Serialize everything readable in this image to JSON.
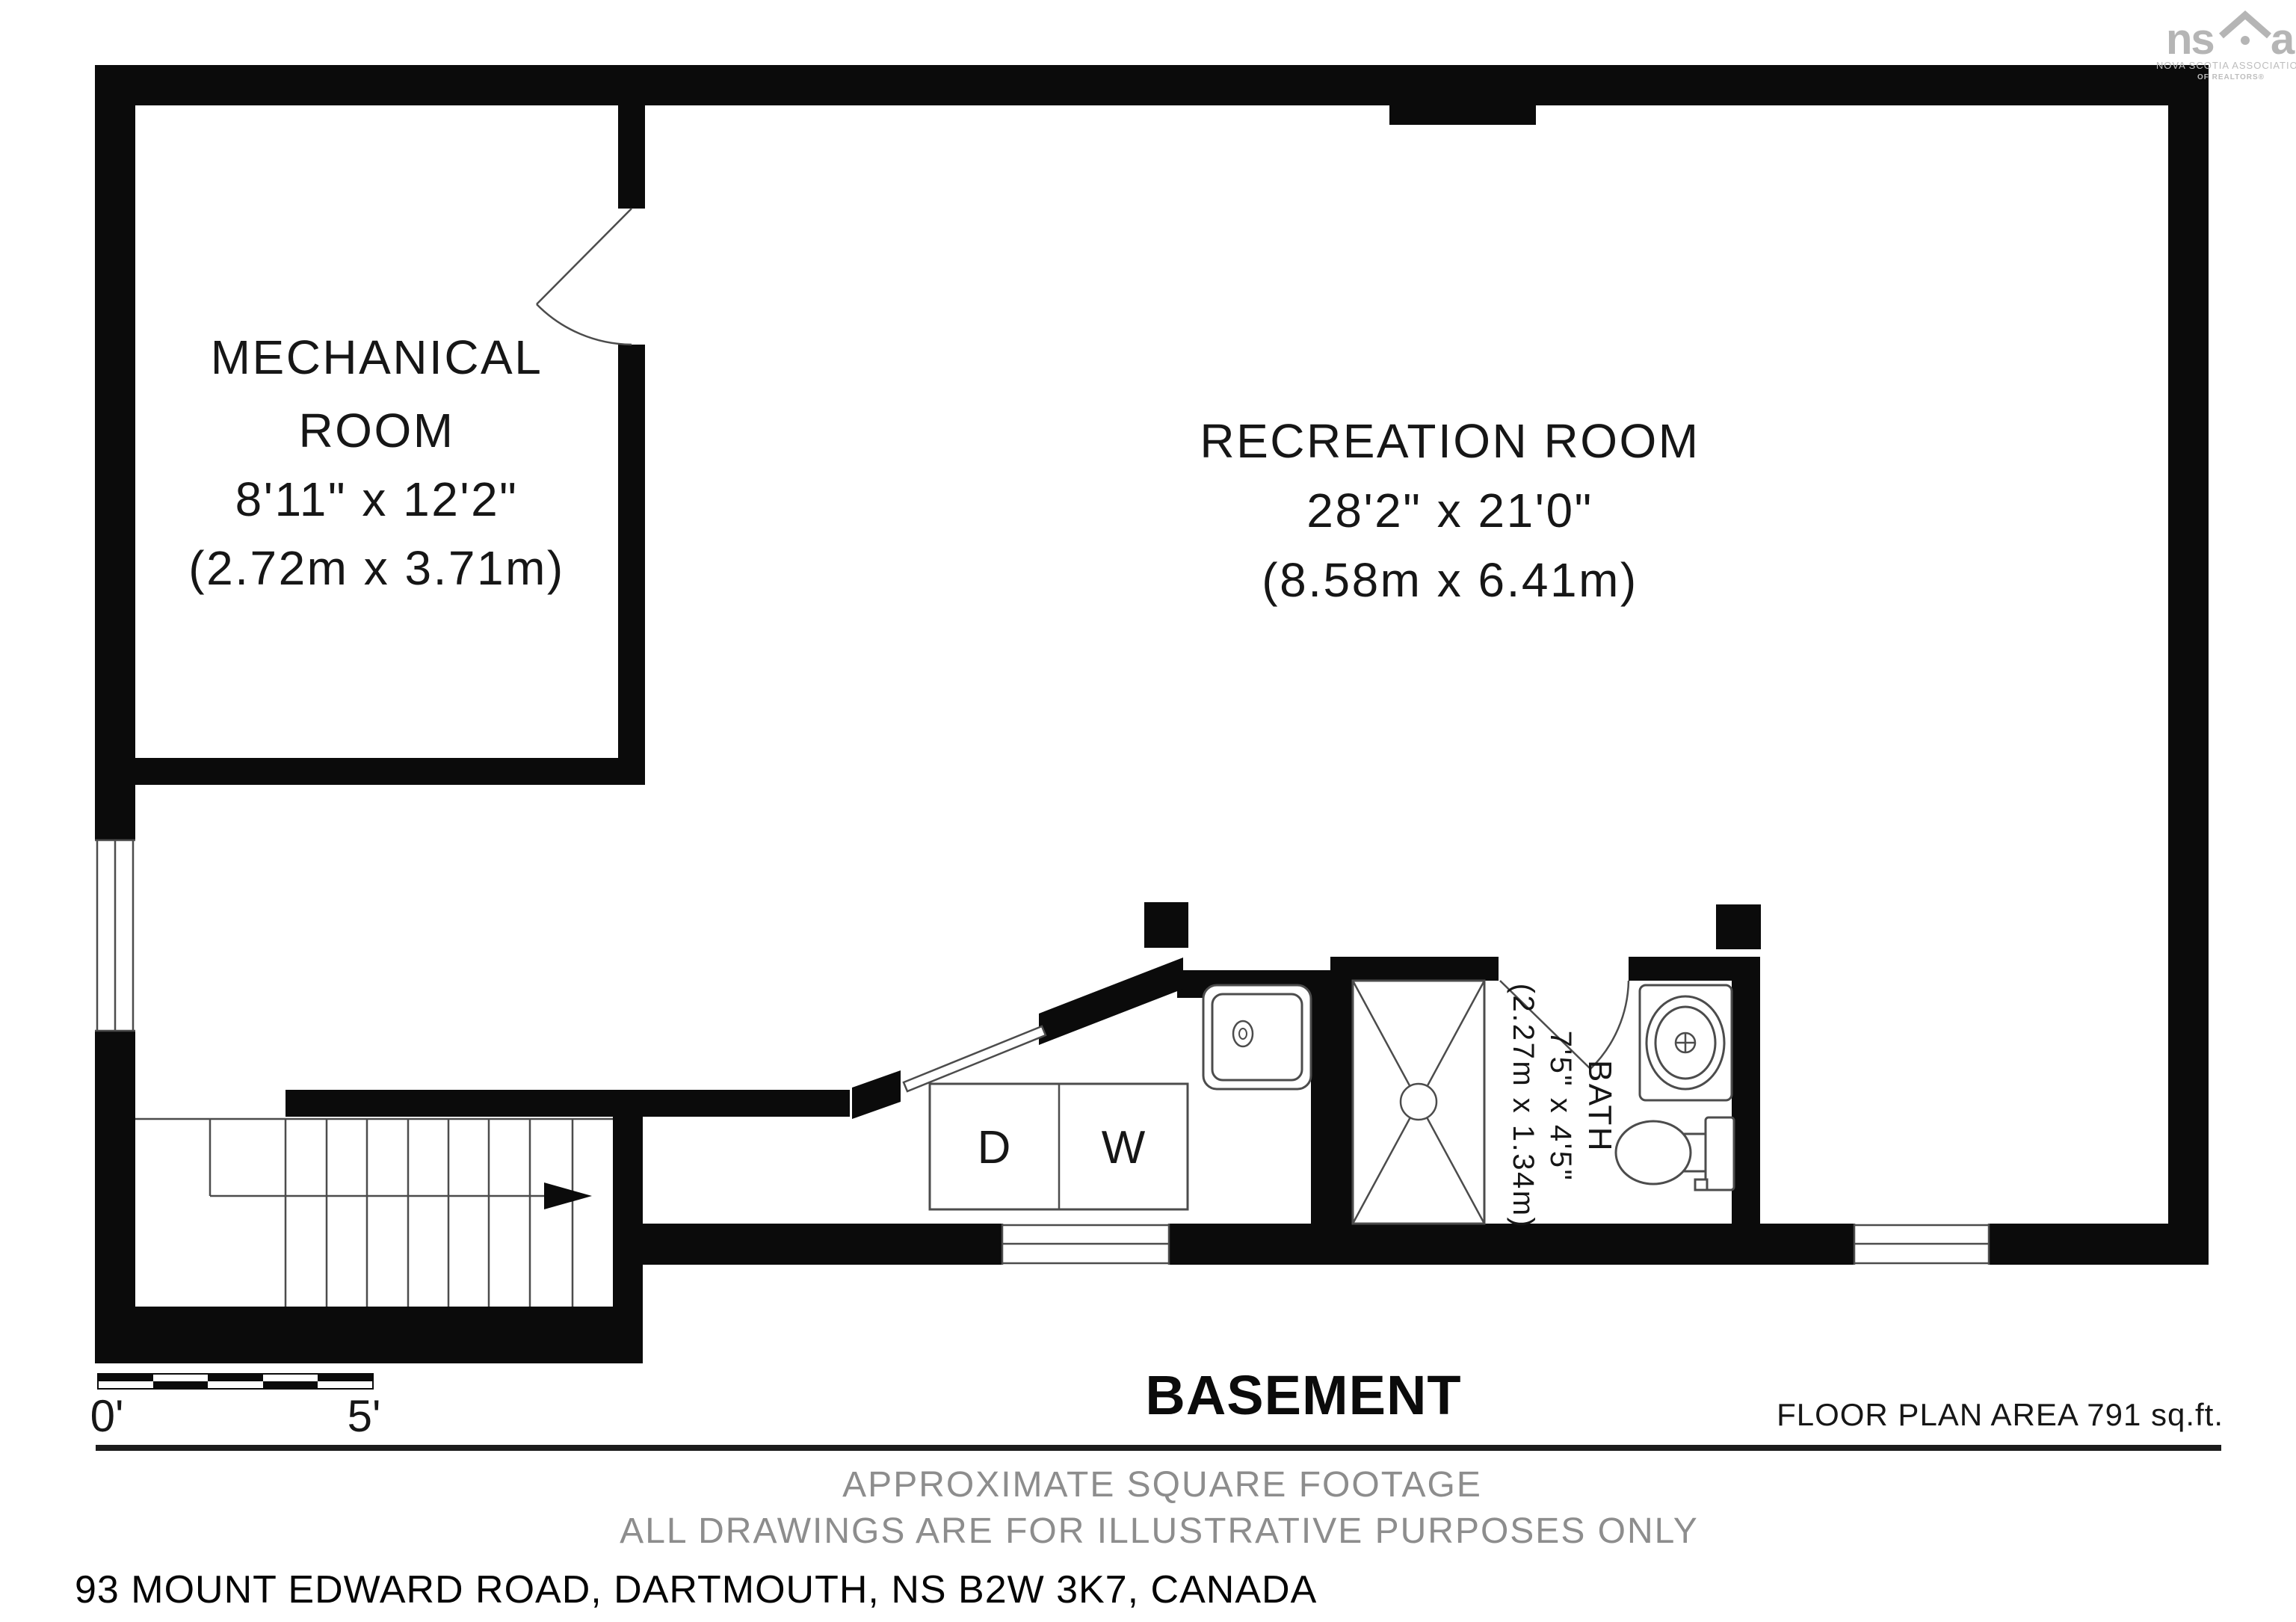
{
  "colors": {
    "wall": "#0b0b0b",
    "thin_line": "#4c4c4c",
    "gray_text": "#8d8d8d",
    "logo_gray": "#b5b5b5",
    "divider": "#1c1c1c"
  },
  "logo": {
    "brand_left": "ns",
    "brand_right": "ar",
    "tagline1": "NOVA SCOTIA ASSOCIATION",
    "tagline2": "OF REALTORS®"
  },
  "rooms": {
    "mechanical": {
      "name_line1": "MECHANICAL",
      "name_line2": "ROOM",
      "dims_imperial": "8'11\" x 12'2\"",
      "dims_metric": "(2.72m x 3.71m)"
    },
    "recreation": {
      "name": "RECREATION ROOM",
      "dims_imperial": "28'2\" x 21'0\"",
      "dims_metric": "(8.58m x 6.41m)"
    },
    "bath": {
      "name": "BATH",
      "dims_imperial": "7'5\" x 4'5\"",
      "dims_metric": "(2.27m x 1.34m)"
    }
  },
  "appliances": {
    "dryer": "D",
    "washer": "W"
  },
  "scale_bar": {
    "start_label": "0'",
    "end_label": "5'"
  },
  "title": {
    "name": "BASEMENT",
    "area": "FLOOR PLAN AREA 791 sq.ft."
  },
  "footer": {
    "line1": "APPROXIMATE SQUARE FOOTAGE",
    "line2": "ALL DRAWINGS ARE FOR ILLUSTRATIVE PURPOSES ONLY",
    "address": "93 MOUNT EDWARD ROAD, DARTMOUTH, NS B2W 3K7, CANADA"
  }
}
